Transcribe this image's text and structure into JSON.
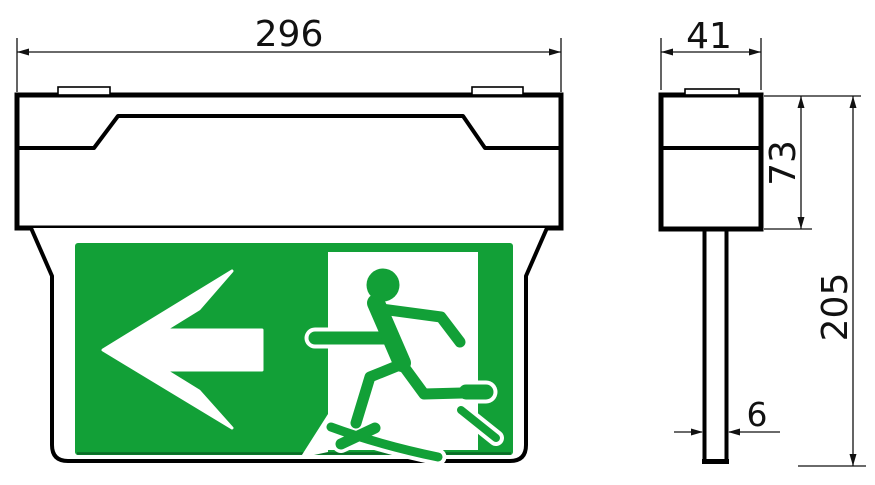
{
  "drawing": {
    "type": "technical-dimension-drawing",
    "product": "emergency-exit-sign-luminaire",
    "dimensions": {
      "front_width": "296",
      "side_depth": "41",
      "housing_height": "73",
      "total_height": "205",
      "blade_thickness": "6"
    },
    "sign": {
      "pictogram": "running-man-exiting-door",
      "arrow_direction": "left",
      "colors": {
        "sign_green": "#12A037",
        "sign_green_dark": "#0b6b26",
        "line_black": "#000000",
        "background": "#ffffff"
      }
    }
  }
}
